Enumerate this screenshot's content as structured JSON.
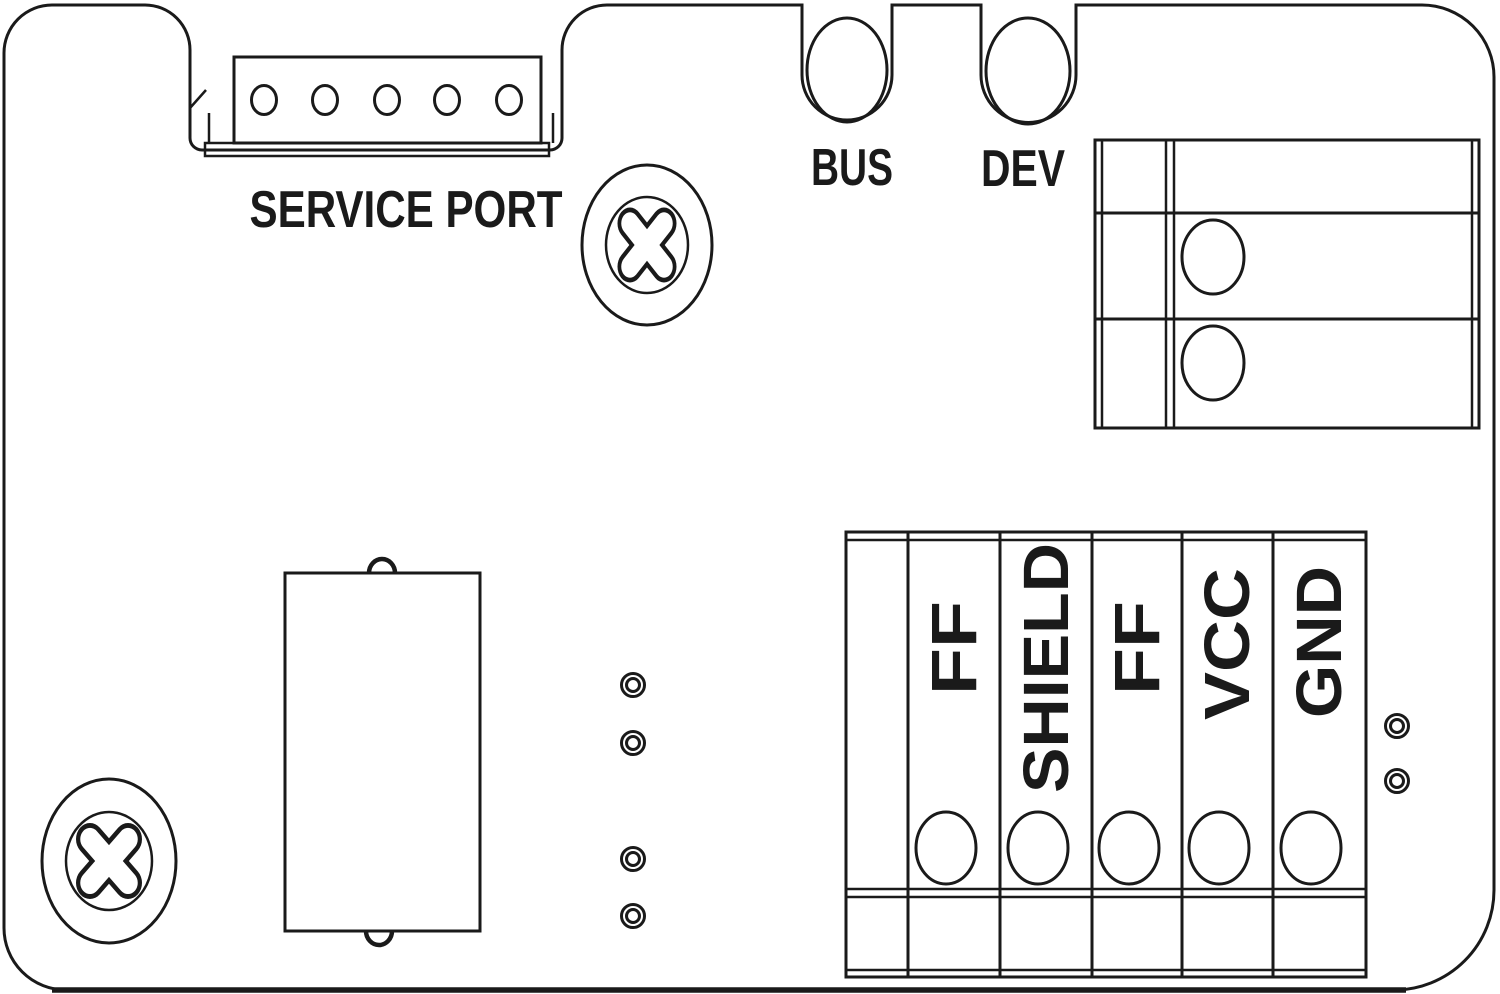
{
  "page": {
    "background": "#ffffff",
    "line_color": "#1a1a1a"
  },
  "service_port": {
    "label": "SERVICE PORT",
    "pin_count": 5
  },
  "indicators": {
    "bus_label": "BUS",
    "dev_label": "DEV"
  },
  "side_block": {
    "rows": 3,
    "screw_hole_count": 2
  },
  "terminal_block": {
    "labels": [
      "FF",
      "SHIELD",
      "FF",
      "VCC",
      "GND"
    ],
    "screw_hole_count": 5
  },
  "test_points": {
    "middle_column_count": 4,
    "right_column_count": 2
  }
}
